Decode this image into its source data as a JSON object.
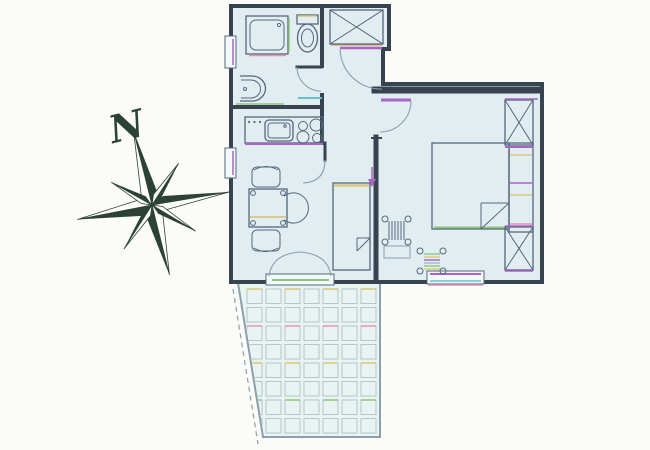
{
  "meta": {
    "type": "apartment-floor-plan-with-terrace"
  },
  "compass": {
    "label": "N"
  },
  "colors": {
    "bg": "#fbfbf8",
    "fill": "#e2edf2",
    "terrace": "#e9f3f1",
    "wall": "#37434e",
    "line": "#53687a",
    "lineLight": "#8ba0ac",
    "tile": "#b5c6cc",
    "purple": "#a964c4",
    "green": "#8fc47e",
    "yellow": "#d9c87b",
    "orange": "#d9a96c",
    "pink": "#e293b4",
    "cyan": "#62c3cf",
    "compass": "#2c4237"
  },
  "terrace": {
    "cols": 7,
    "rows": 8,
    "tile_w": 15,
    "tile_h": 14.5,
    "gap": 4,
    "origin_x": 247,
    "origin_y": 289,
    "accent_rows": [
      [
        0,
        "yellow"
      ],
      [
        2,
        "pink"
      ],
      [
        4,
        "yellow"
      ],
      [
        6,
        "green"
      ]
    ]
  },
  "elements": {
    "rooms": [
      "bathroom",
      "hall",
      "kitchen",
      "living-room",
      "bedroom",
      "terrace"
    ],
    "fixtures": [
      "shower",
      "toilet",
      "wash-basin",
      "kitchen-sink",
      "cooktop-burners"
    ],
    "furniture": [
      "dining-table",
      "dining-chairs",
      "single-bed",
      "double-bed",
      "headboard-shelf",
      "wardrobe",
      "radiator"
    ],
    "openings": [
      "entrance-door",
      "bathroom-door",
      "bedroom-door",
      "living-room-door",
      "french-double-door",
      "window"
    ]
  }
}
